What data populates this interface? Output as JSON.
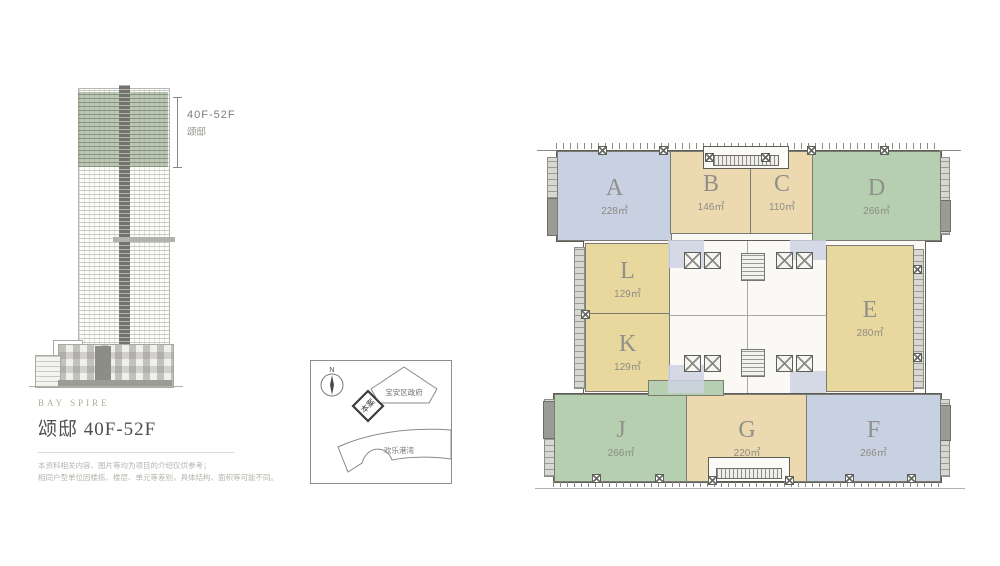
{
  "page": {
    "background": "#ffffff"
  },
  "elevation": {
    "range_label": "40F-52F",
    "range_sublabel": "颂邸",
    "highlight_color": "#7c9370"
  },
  "info": {
    "brand": "BAY SPIRE",
    "title": "颂邸 40F-52F",
    "disclaimer_line1": "本资料相关内容、图片等均为项目的介绍仅供参考；",
    "disclaimer_line2": "相同户型单位因楼栋、楼层、单元等差别，具体结构、面积等可能不同。"
  },
  "map": {
    "north_label": "N",
    "government_label": "宝安区政府",
    "site_label": "本案",
    "bay_label": "欢乐港湾"
  },
  "floorplan": {
    "legend_colors": {
      "blue": "#c8d1e2",
      "tan": "#edd9b0",
      "green": "#b6cfb1",
      "yellow": "#e9d89d"
    },
    "units": [
      {
        "id": "A",
        "area": "228㎡",
        "color": "#c8d1e2"
      },
      {
        "id": "B",
        "area": "146㎡",
        "color": "#edd9b0"
      },
      {
        "id": "C",
        "area": "110㎡",
        "color": "#edd9b0"
      },
      {
        "id": "D",
        "area": "266㎡",
        "color": "#b6cfb1"
      },
      {
        "id": "L",
        "area": "129㎡",
        "color": "#e9d89d"
      },
      {
        "id": "K",
        "area": "129㎡",
        "color": "#e9d89d"
      },
      {
        "id": "E",
        "area": "280㎡",
        "color": "#e9d89d"
      },
      {
        "id": "J",
        "area": "266㎡",
        "color": "#b6cfb1"
      },
      {
        "id": "G",
        "area": "220㎡",
        "color": "#edd9b0"
      },
      {
        "id": "F",
        "area": "266㎡",
        "color": "#c8d1e2"
      }
    ]
  }
}
